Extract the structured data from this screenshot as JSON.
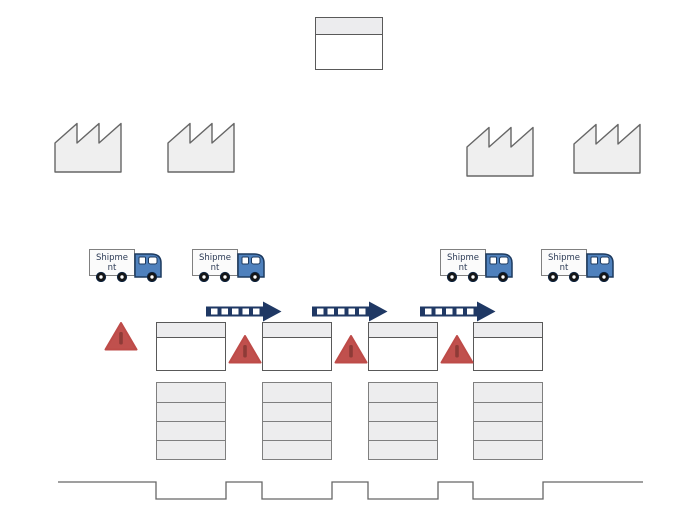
{
  "colors": {
    "background": "#ffffff",
    "shape_fill": "#ededee",
    "shape_border": "#595959",
    "row_border": "#7f7f7f",
    "factory_fill": "#efefef",
    "factory_border": "#666666",
    "push_arrow": "#1f3864",
    "warning_triangle": "#c0504d",
    "warning_triangle_bar": "#8e3b37",
    "truck_cab": "#4f81bd",
    "truck_wheel": "#161616",
    "timeline_line": "#666666"
  },
  "production_control_box": {
    "text": ""
  },
  "factories": {
    "count": 4
  },
  "trucks": [
    {
      "label": "Shipment"
    },
    {
      "label": "Shipment"
    },
    {
      "label": "Shipment"
    },
    {
      "label": "Shipment"
    }
  ],
  "push_arrows": {
    "count": 3,
    "style": "striped-push-arrow"
  },
  "warning_triangles": {
    "count": 4
  },
  "process_boxes": {
    "count": 4,
    "text": ""
  },
  "data_tables": {
    "count": 4,
    "rows_each": 4,
    "text": ""
  },
  "timeline": {
    "style": "step-ladder",
    "high_segments": 5,
    "low_segments": 4
  }
}
